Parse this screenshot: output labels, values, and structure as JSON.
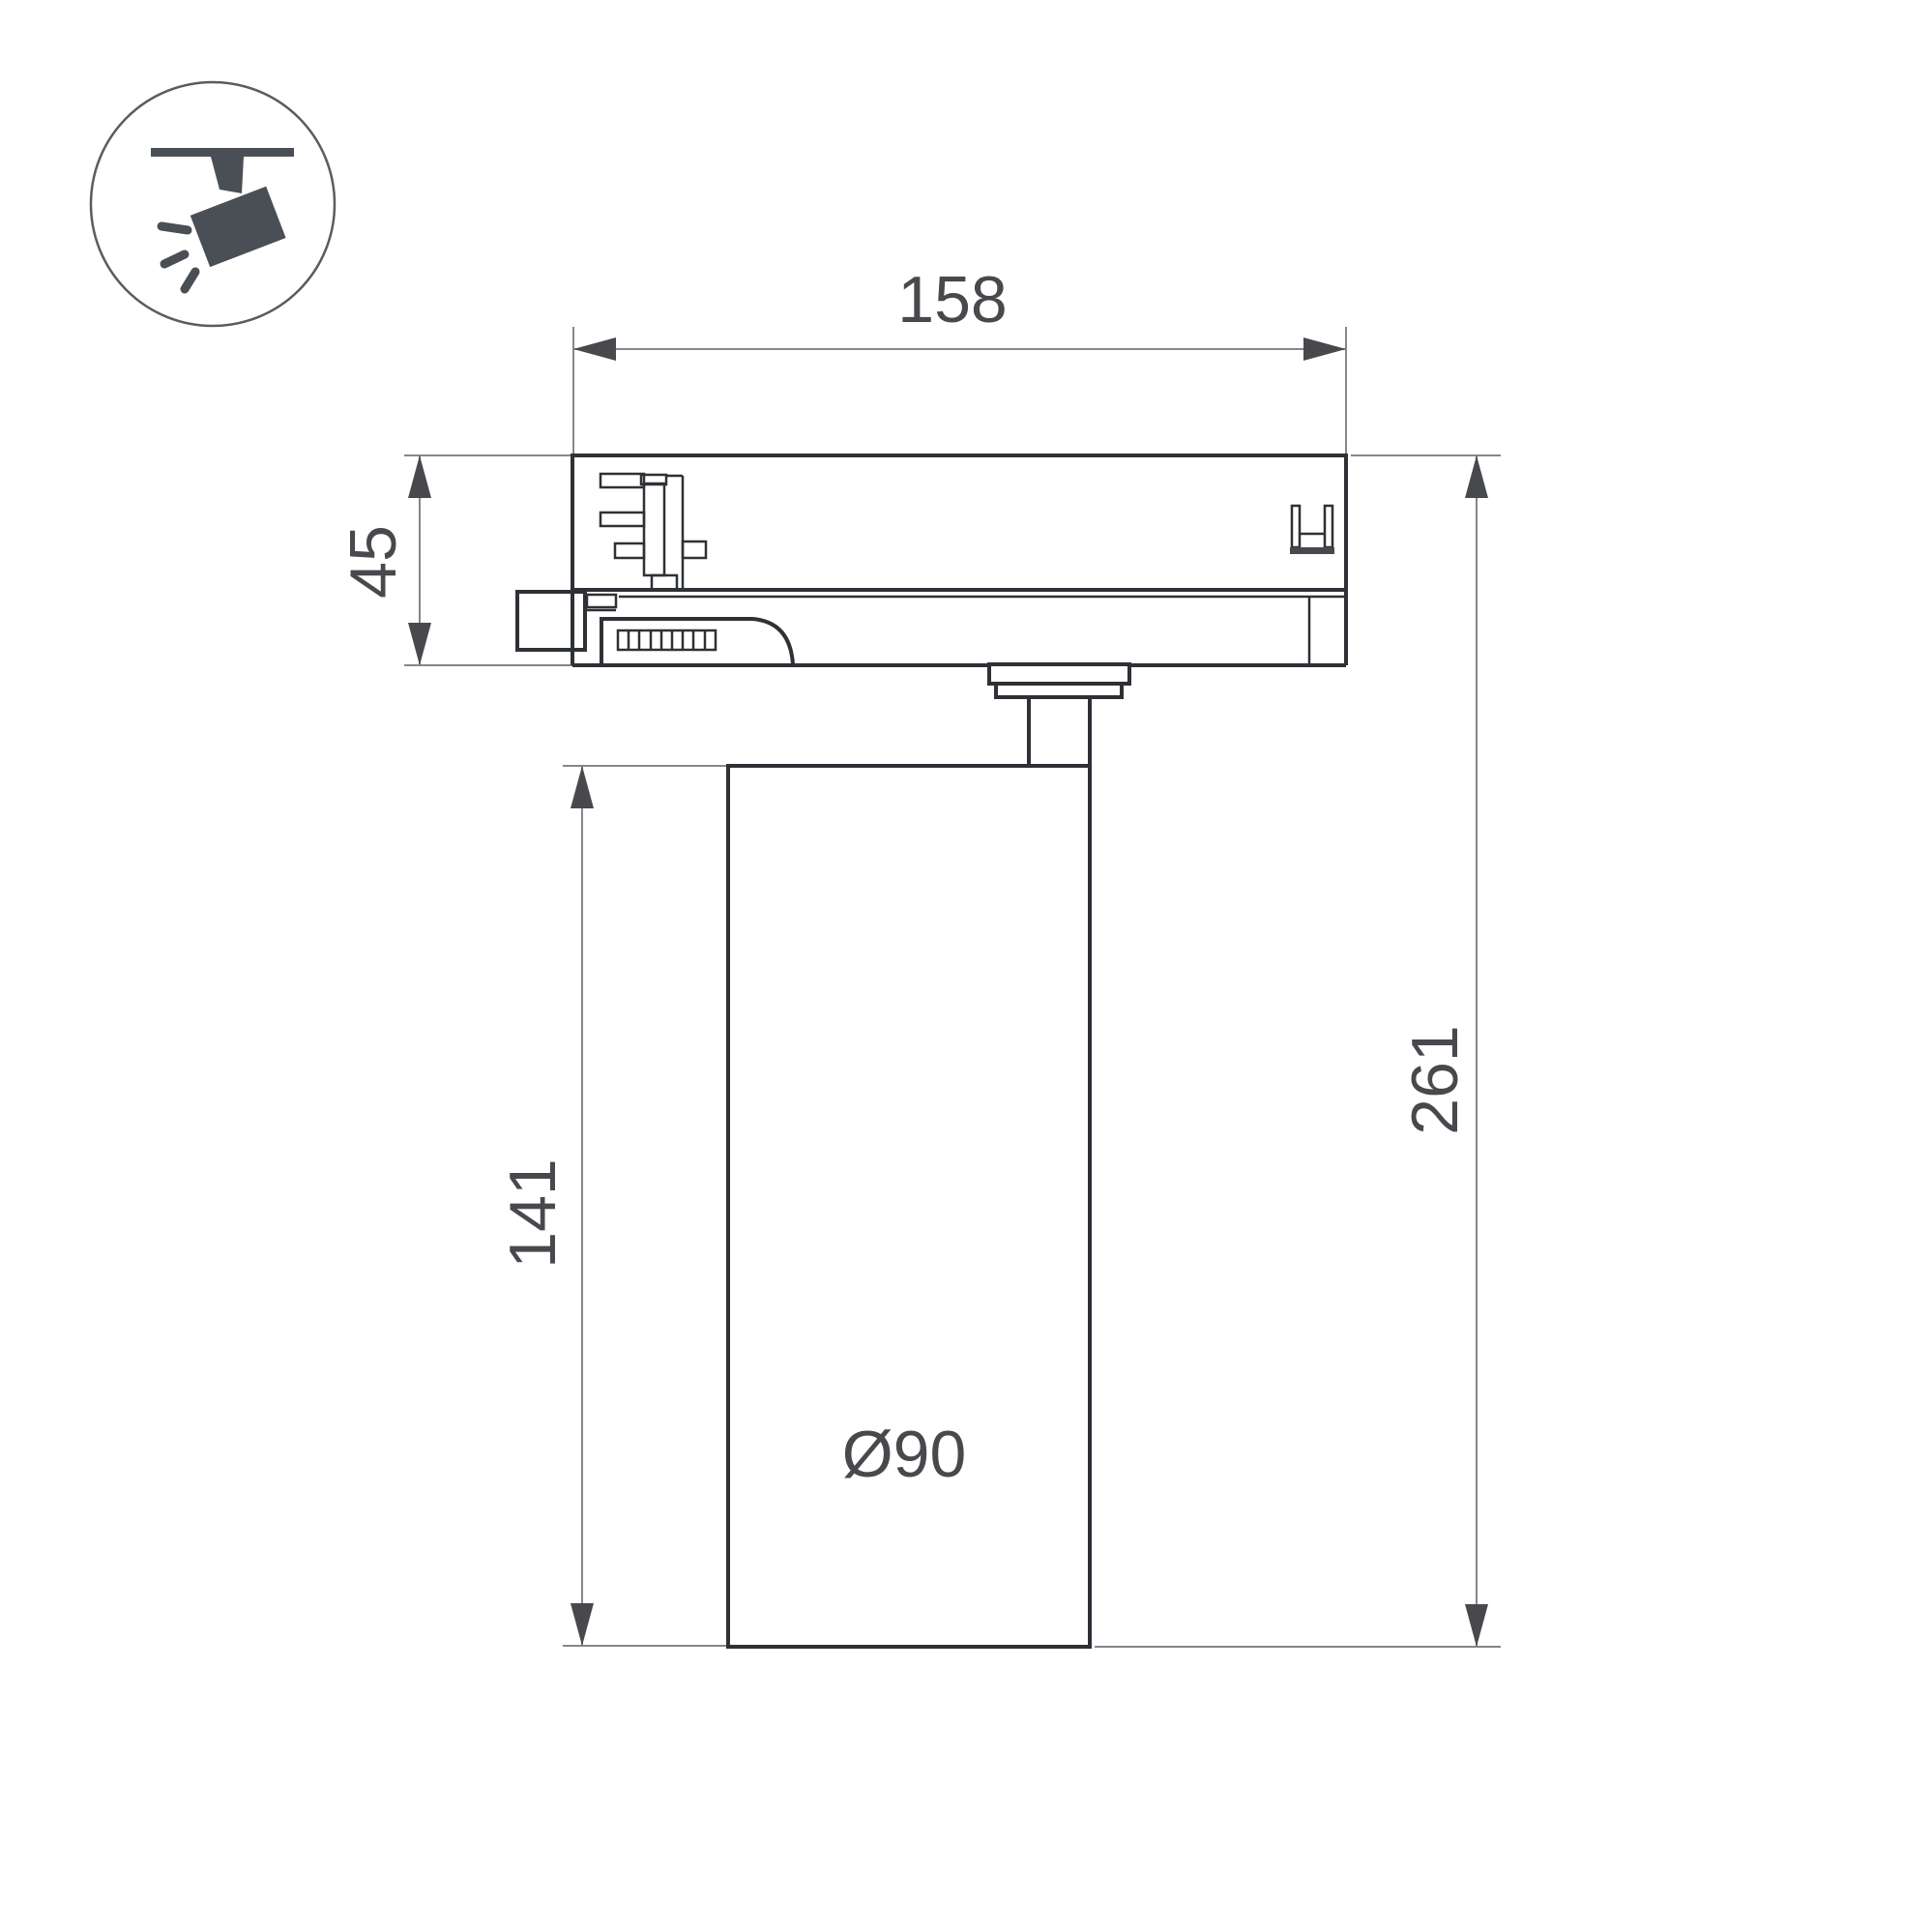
{
  "colors": {
    "background": "#ffffff",
    "outline": "#2e3135",
    "dim_line": "#85878a",
    "annotation": "#47494d",
    "icon": "#4a4f55"
  },
  "icon_legend": {
    "name": "ceiling-track-spotlight-icon"
  },
  "labels": {
    "adapter_width": "158",
    "adapter_height": "45",
    "body_height": "141",
    "total_height": "261",
    "body_diameter": "Ø90"
  }
}
